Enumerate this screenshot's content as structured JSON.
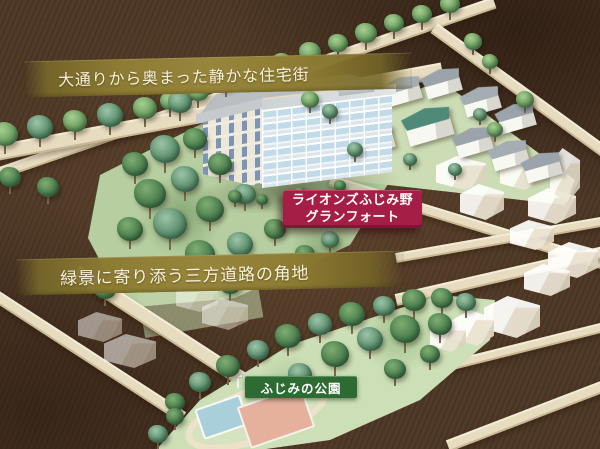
{
  "illustration": {
    "type": "isometric-aerial-neighborhood-map",
    "captions": {
      "top_band": "大通りから奥まった静かな住宅街",
      "middle_band": "緑景に寄り添う三方道路の角地"
    },
    "badges": {
      "property": {
        "line1": "ライオンズふじみ野",
        "line2": "グランフォート"
      },
      "park": {
        "label": "ふじみの公園"
      }
    },
    "colors": {
      "background_brown": "#4c3624",
      "band_gold": "#8d7c33",
      "band_text": "#f7f2dd",
      "badge_red": "#a51e45",
      "badge_green": "#2d6b33",
      "road_cream": "#e7dcc0",
      "park_green": "#ccdfb6",
      "garden_green": "#b7cfa0",
      "building_white": "#f4f6f7",
      "balcony_blue": "#c3dae9",
      "pool_blue": "#a9cfdb",
      "court_pink": "#e5b19d"
    }
  }
}
